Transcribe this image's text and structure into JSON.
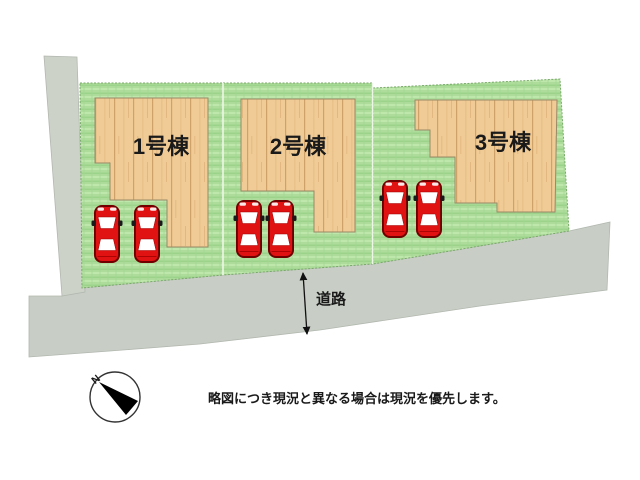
{
  "site_plan": {
    "lots": [
      {
        "label": "1号棟",
        "cars": 2
      },
      {
        "label": "2号棟",
        "cars": 2
      },
      {
        "label": "3号棟",
        "cars": 2
      }
    ],
    "road": {
      "label": "道路"
    },
    "compass": {
      "north_label": "N"
    },
    "note": "略図につき現況と異なる場合は現況を優先します。",
    "colors": {
      "grass": "#aedc9b",
      "grass_stripe": "#bde7ab",
      "wood": "#f0cb95",
      "wood_grain": "#cfa269",
      "road": "#c8cec5",
      "road_strip": "#cdd2c9",
      "car_body": "#e01212",
      "car_outline": "#700000",
      "text": "#1a1a1a",
      "background": "#ffffff"
    }
  }
}
